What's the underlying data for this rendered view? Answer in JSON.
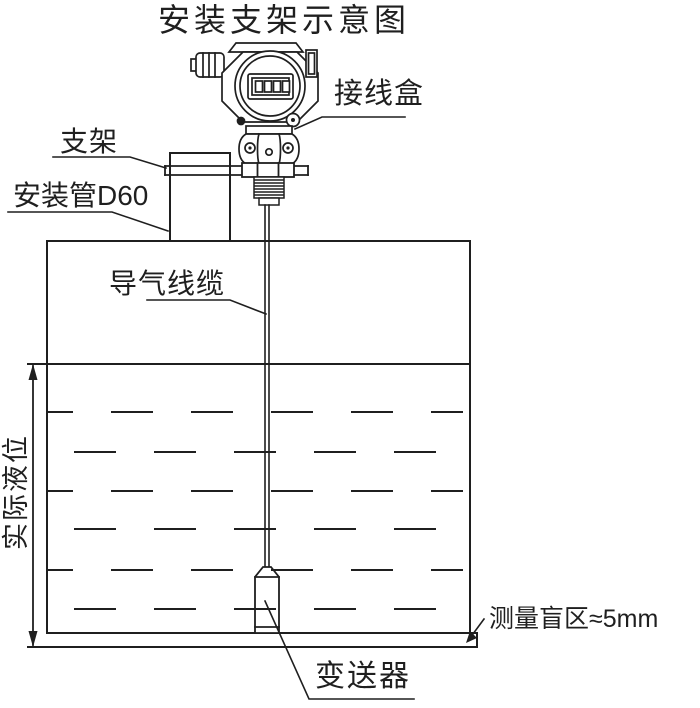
{
  "title": "安装支架示意图",
  "labels": {
    "junction_box": "接线盒",
    "bracket": "支架",
    "mounting_pipe": "安装管D60",
    "air_cable": "导气线缆",
    "actual_level": "实际液位",
    "blind_zone": "测量盲区≈5mm",
    "transmitter": "变送器"
  },
  "colors": {
    "line": "#1f1f1f",
    "background": "#ffffff"
  }
}
